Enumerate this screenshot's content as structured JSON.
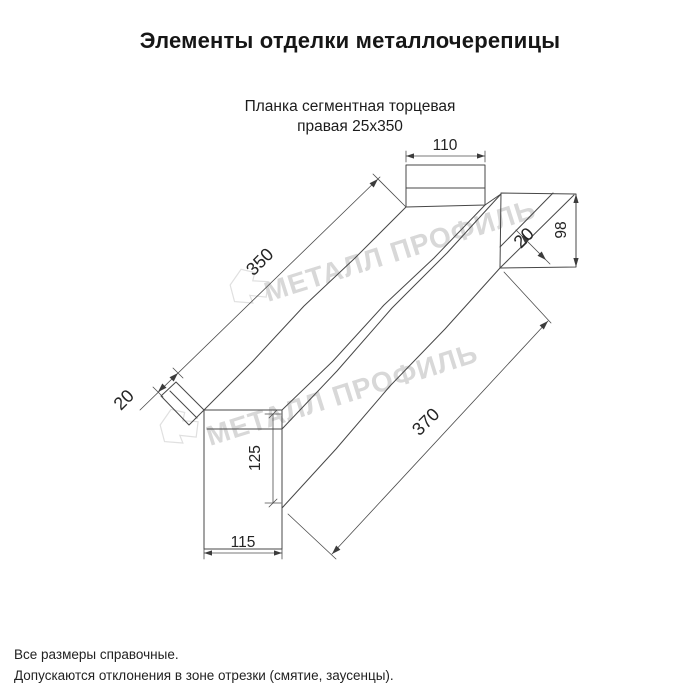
{
  "page": {
    "title": "Элементы отделки металлочерепицы"
  },
  "drawing": {
    "subtitle_line1": "Планка сегментная торцевая",
    "subtitle_line2": "правая 25x350",
    "watermark_text": "МЕТАЛЛ ПРОФИЛЬ",
    "dimensions": {
      "top_flange_width": "110",
      "right_end_height": "98",
      "right_hem": "20",
      "top_face_length": "350",
      "left_hem": "20",
      "side_face_length": "370",
      "left_end_height": "125",
      "left_end_width": "115"
    }
  },
  "footer": {
    "note1": "Все размеры справочные.",
    "note2": "Допускаются отклонения в зоне отрезки (смятие, заусенцы)."
  },
  "colors": {
    "background": "#ffffff",
    "line": "#474747",
    "text": "#1a1a1a",
    "watermark": "#d8d8d8"
  }
}
